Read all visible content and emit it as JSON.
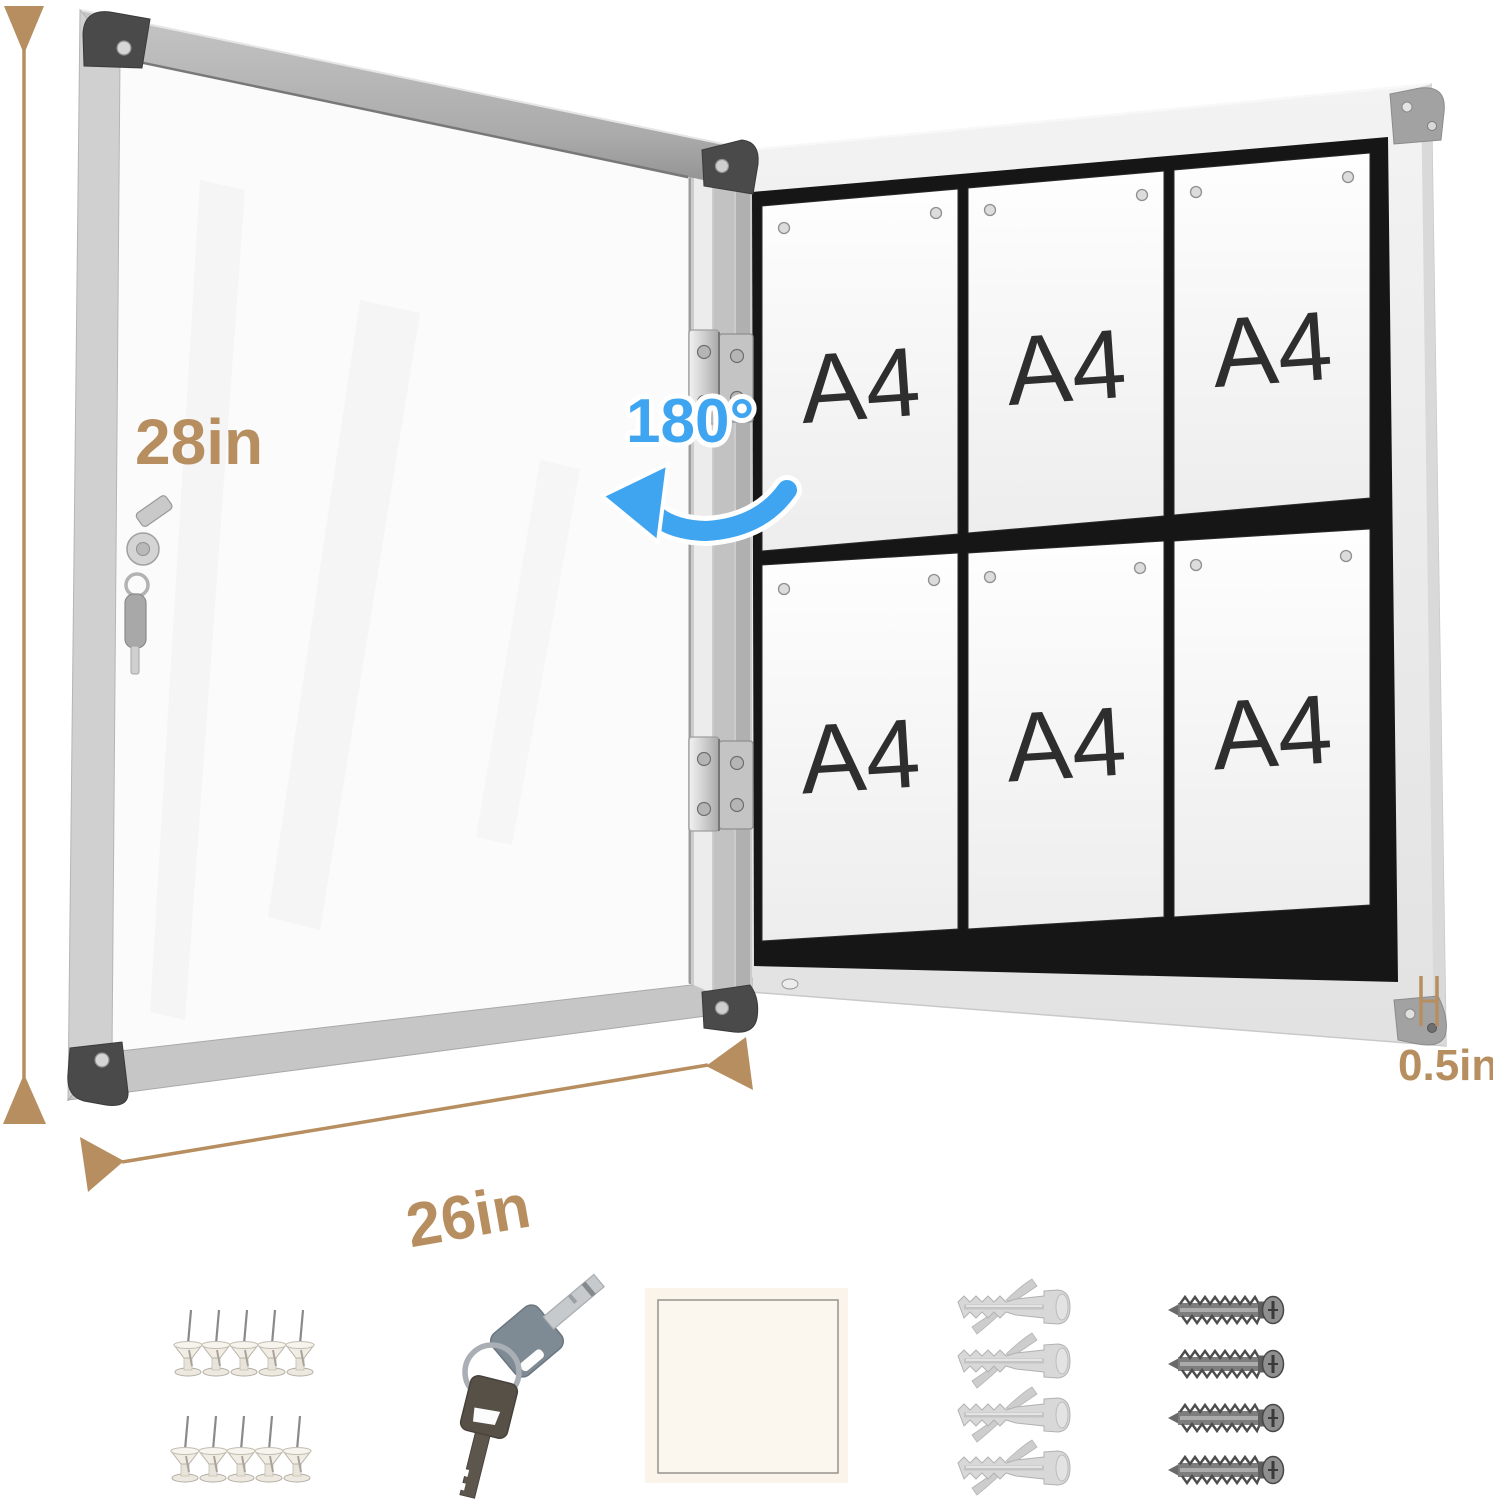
{
  "dimensions": {
    "height_label": "28in",
    "width_label": "26in",
    "depth_label": "0.5in",
    "open_angle_label": "180°"
  },
  "board": {
    "papers": [
      {
        "label": "A4"
      },
      {
        "label": "A4"
      },
      {
        "label": "A4"
      },
      {
        "label": "A4"
      },
      {
        "label": "A4"
      },
      {
        "label": "A4"
      }
    ]
  },
  "accessories": {
    "push_pin_count": 10,
    "key_count": 2,
    "anchor_count": 4,
    "screw_count": 4,
    "items": [
      "push-pins",
      "keys",
      "adhesive-pad",
      "wall-anchors",
      "screws"
    ]
  },
  "colors": {
    "dimension_label": "#b78e60",
    "angle_label": "#3fa5f0",
    "board_frame": "#ededed",
    "felt": "#161616",
    "a4_text": "#2e2e2e"
  }
}
